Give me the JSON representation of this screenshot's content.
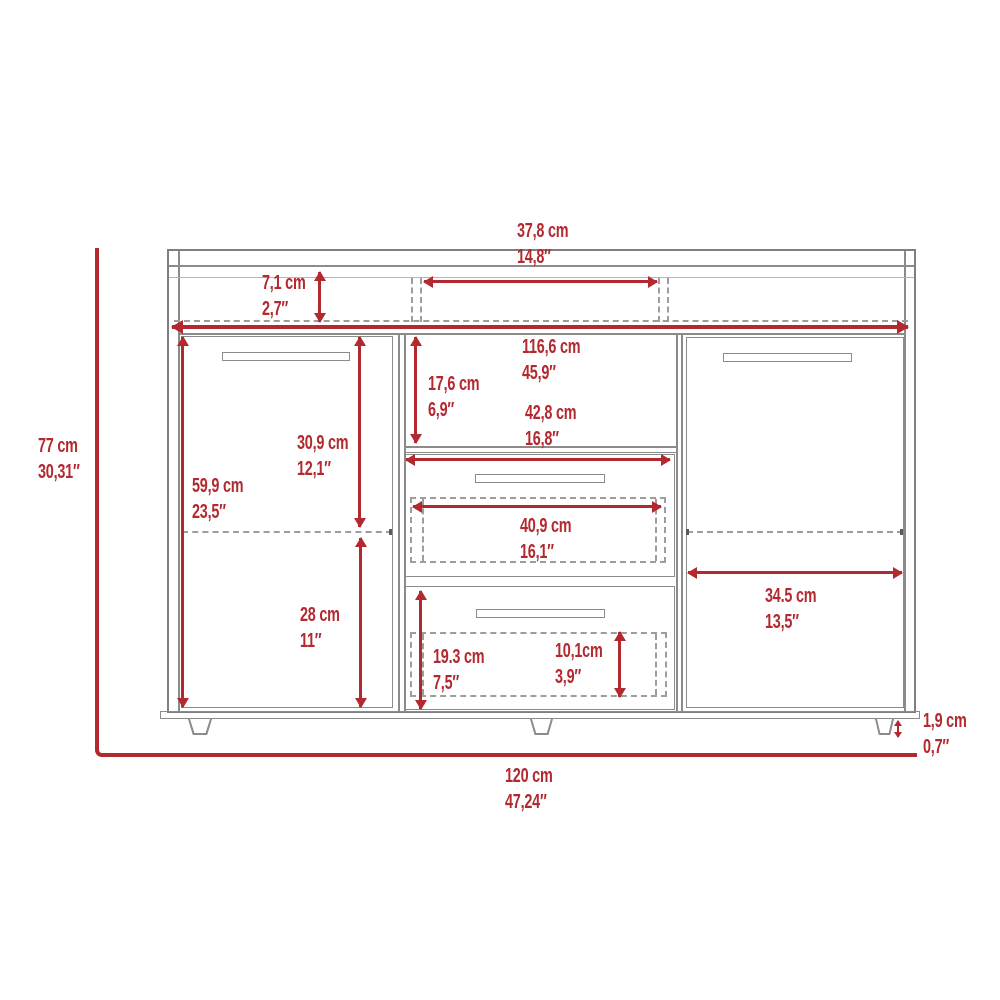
{
  "style": {
    "accent_red": "#b2292f",
    "line_gray": "#8b8b8b",
    "background": "#ffffff"
  },
  "diagram": {
    "kind": "furniture dimension drawing",
    "view": "sideboard front elevation with two doors, two drawers and open shelves"
  },
  "dims": {
    "overall_height": {
      "cm": "77 cm",
      "in": "30,31″"
    },
    "overall_width": {
      "cm": "120 cm",
      "in": "47,24″"
    },
    "top_opening_width": {
      "cm": "37,8 cm",
      "in": "14,8″"
    },
    "top_shelf_height": {
      "cm": "7,1 cm",
      "in": "2,7″"
    },
    "interior_width": {
      "cm": "116,6 cm",
      "in": "45,9″"
    },
    "cubby_height": {
      "cm": "17,6 cm",
      "in": "6,9″"
    },
    "drawer_width": {
      "cm": "42,8 cm",
      "in": "16,8″"
    },
    "drawer_inner_width": {
      "cm": "40,9 cm",
      "in": "16,1″"
    },
    "door_height": {
      "cm": "59,9 cm",
      "in": "23,5″"
    },
    "door_upper_height": {
      "cm": "30,9 cm",
      "in": "12,1″"
    },
    "door_lower_height": {
      "cm": "28 cm",
      "in": "11″"
    },
    "bottom_drawer_height": {
      "cm": "19.3 cm",
      "in": "7,5″"
    },
    "bottom_drawer_inner_height": {
      "cm": "10,1cm",
      "in": "3,9″"
    },
    "right_door_width": {
      "cm": "34.5 cm",
      "in": "13,5″"
    },
    "leg_height": {
      "cm": "1,9 cm",
      "in": "0,7″"
    }
  }
}
